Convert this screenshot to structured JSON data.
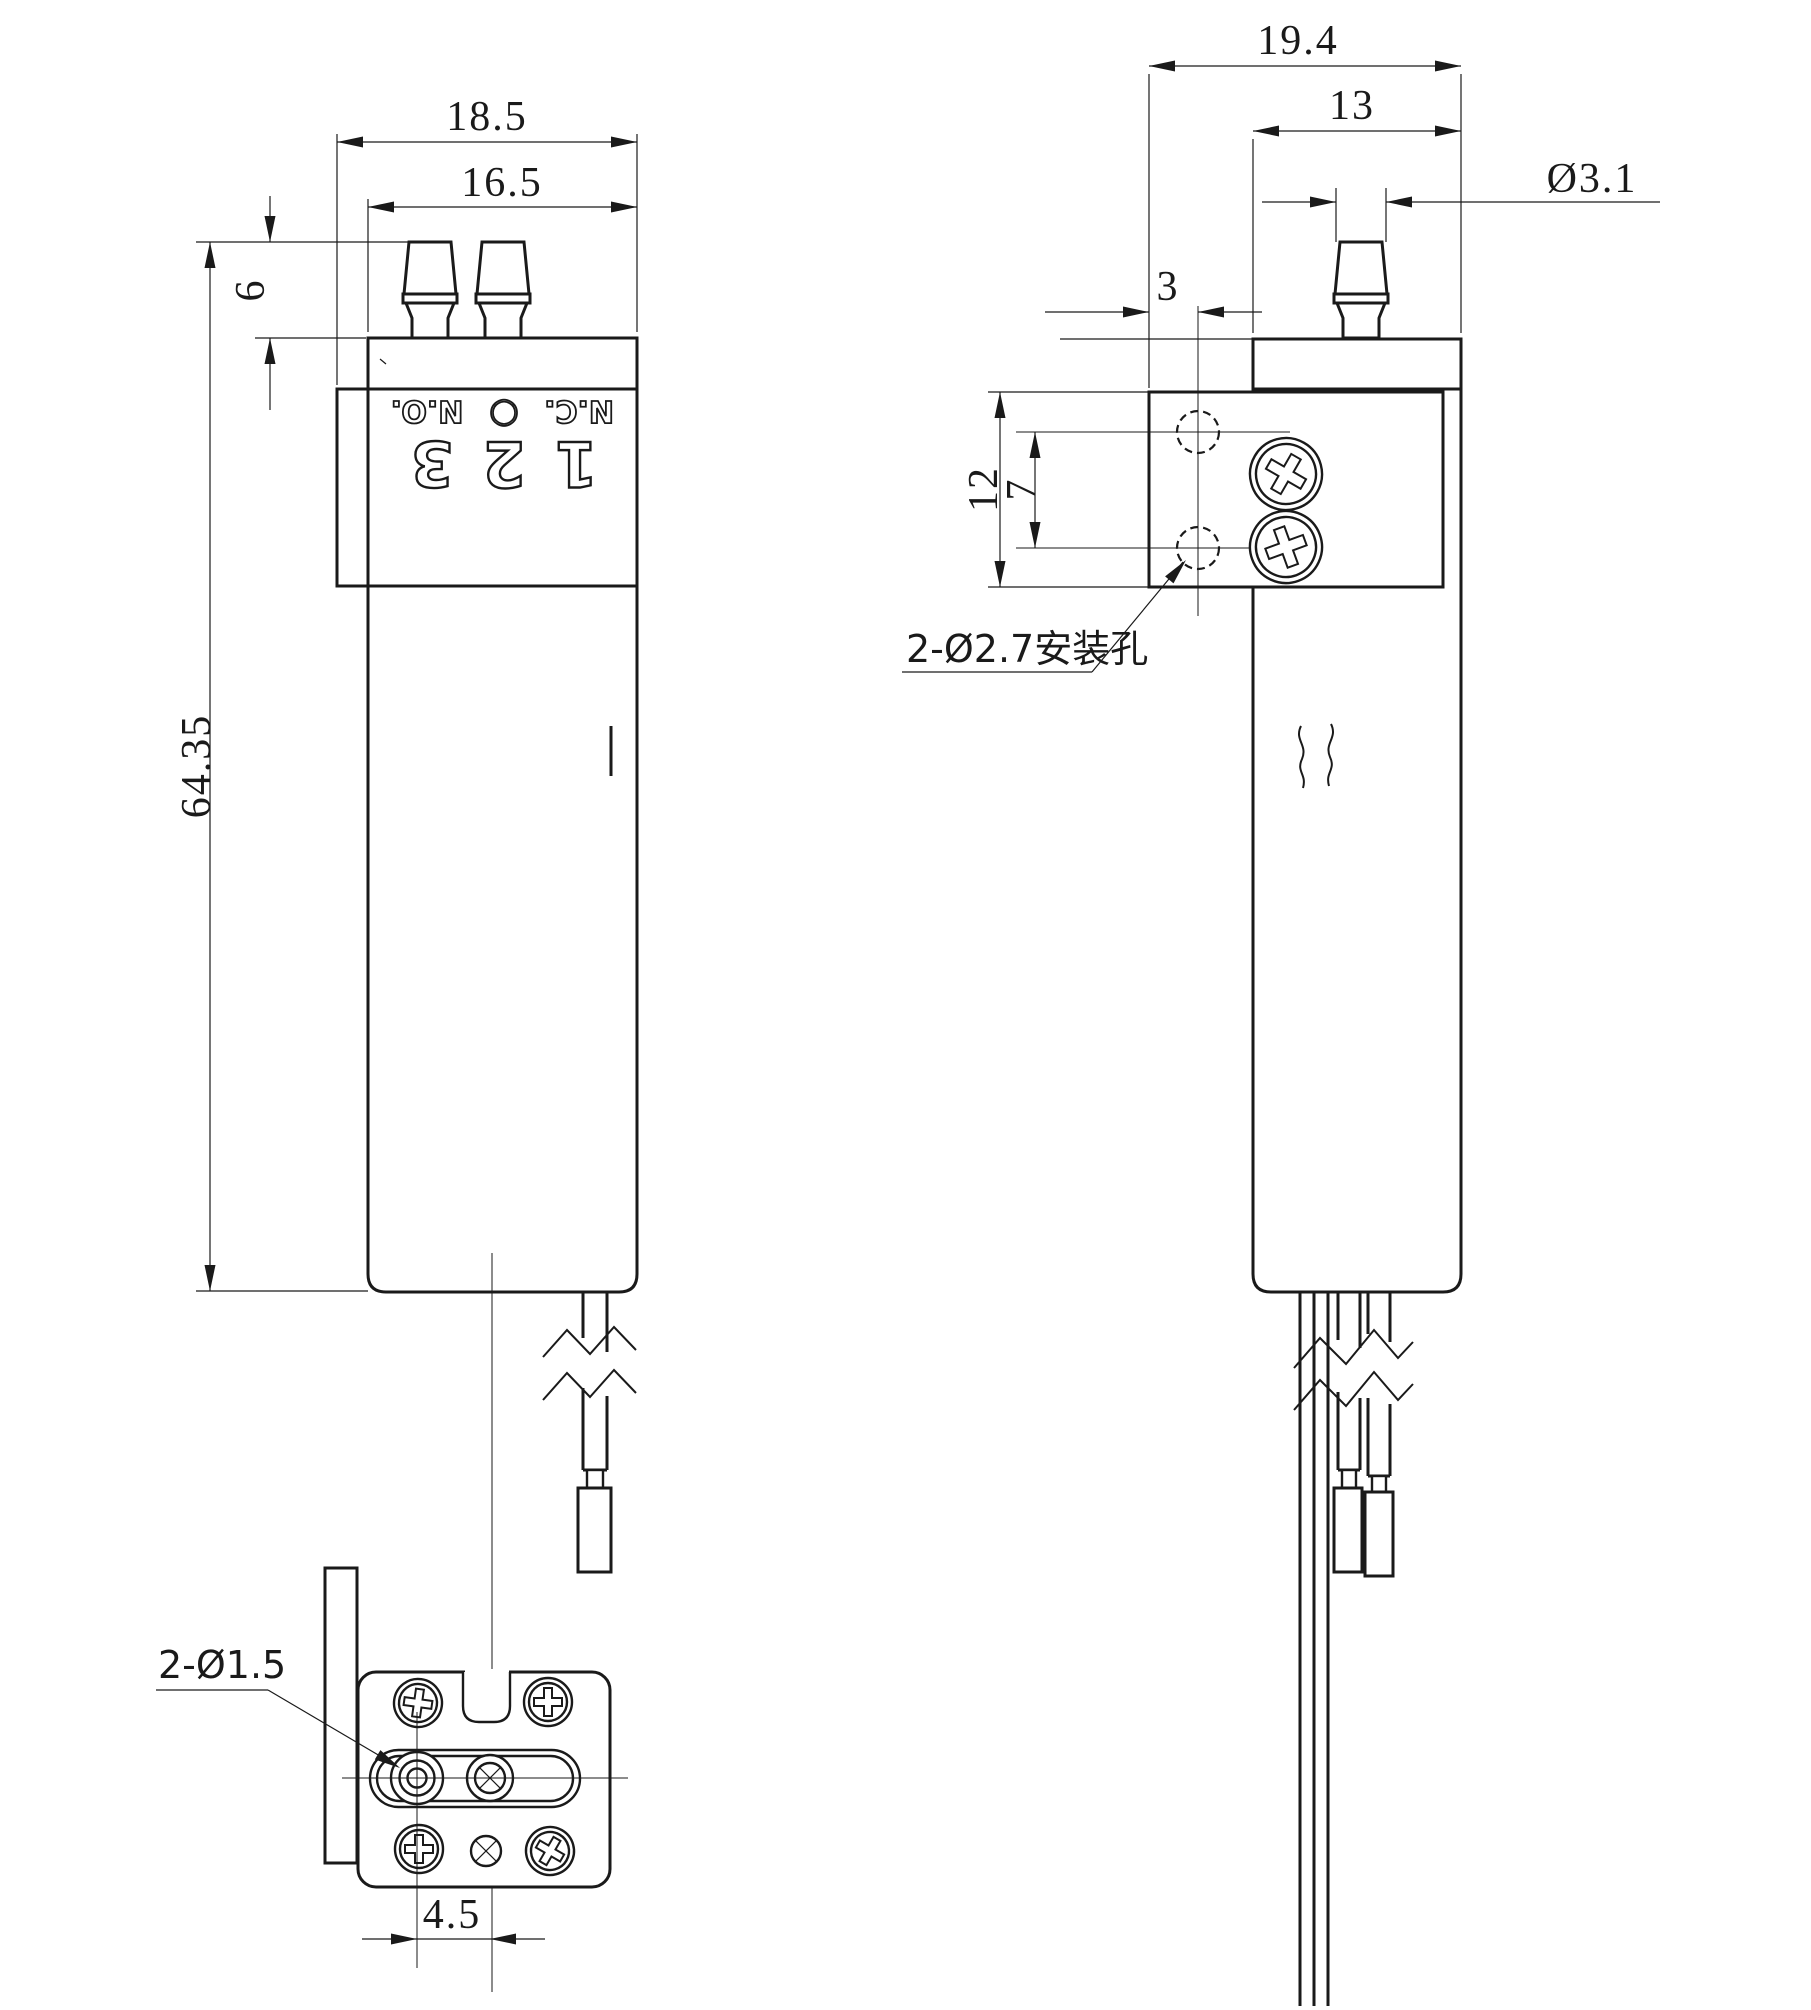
{
  "front_view": {
    "dims": {
      "outer_width": "18.5",
      "plate_width": "16.5",
      "nipple_height": "6",
      "total_height": "64.35"
    },
    "terminals": [
      {
        "num": "1",
        "tag": "N.C."
      },
      {
        "num": "2",
        "tag": "○"
      },
      {
        "num": "3",
        "tag": "N.O."
      }
    ]
  },
  "side_view": {
    "dims": {
      "outer_depth": "19.4",
      "body_depth": "13",
      "barb_diameter": "Ø3.1",
      "hole_face_offset": "3",
      "bracket_span": "12",
      "hole_pitch": "7"
    },
    "notes": {
      "mounting_holes": "2-Ø2.7安装孔"
    }
  },
  "bottom_view": {
    "dims": {
      "port_pitch": "4.5"
    },
    "notes": {
      "ports": "2-Ø1.5"
    }
  },
  "colors": {
    "line": "#1a1a1a",
    "background": "#ffffff"
  }
}
